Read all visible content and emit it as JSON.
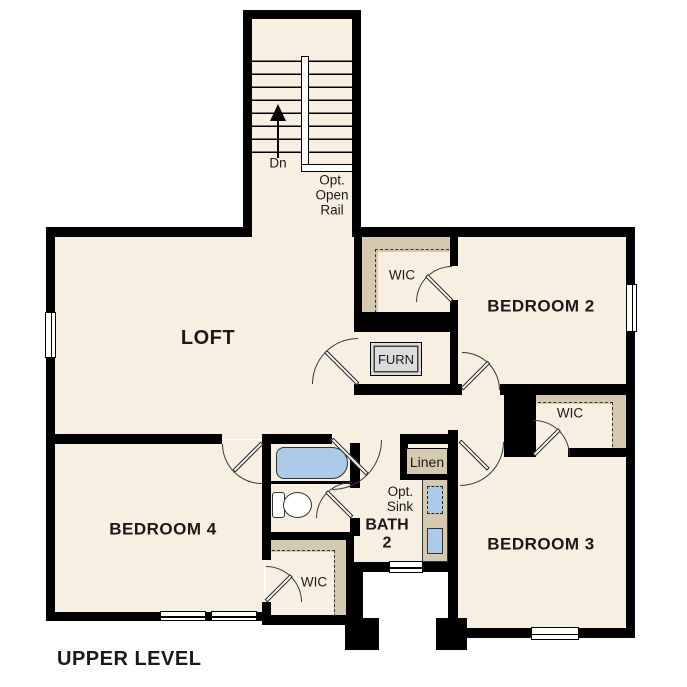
{
  "plan_title": "UPPER LEVEL",
  "rooms": {
    "loft": "LOFT",
    "bedroom2": "BEDROOM 2",
    "bedroom3": "BEDROOM 3",
    "bedroom4": "BEDROOM 4",
    "bath2": "BATH\n2",
    "wic_top": "WIC",
    "wic_right": "WIC",
    "wic_bottom": "WIC",
    "linen": "Linen",
    "furnace": "FURN"
  },
  "labels": {
    "stair_direction": "Dn",
    "optional_rail": "Opt.\nOpen\nRail",
    "optional_sink": "Opt.\nSink"
  },
  "colors": {
    "floor": "#f7efe1",
    "wall": "#000000",
    "shelving": "#d5c9af",
    "fixture_blue": "#abcbe9",
    "furnace_fill": "#dcdcdc",
    "background": "#ffffff"
  }
}
